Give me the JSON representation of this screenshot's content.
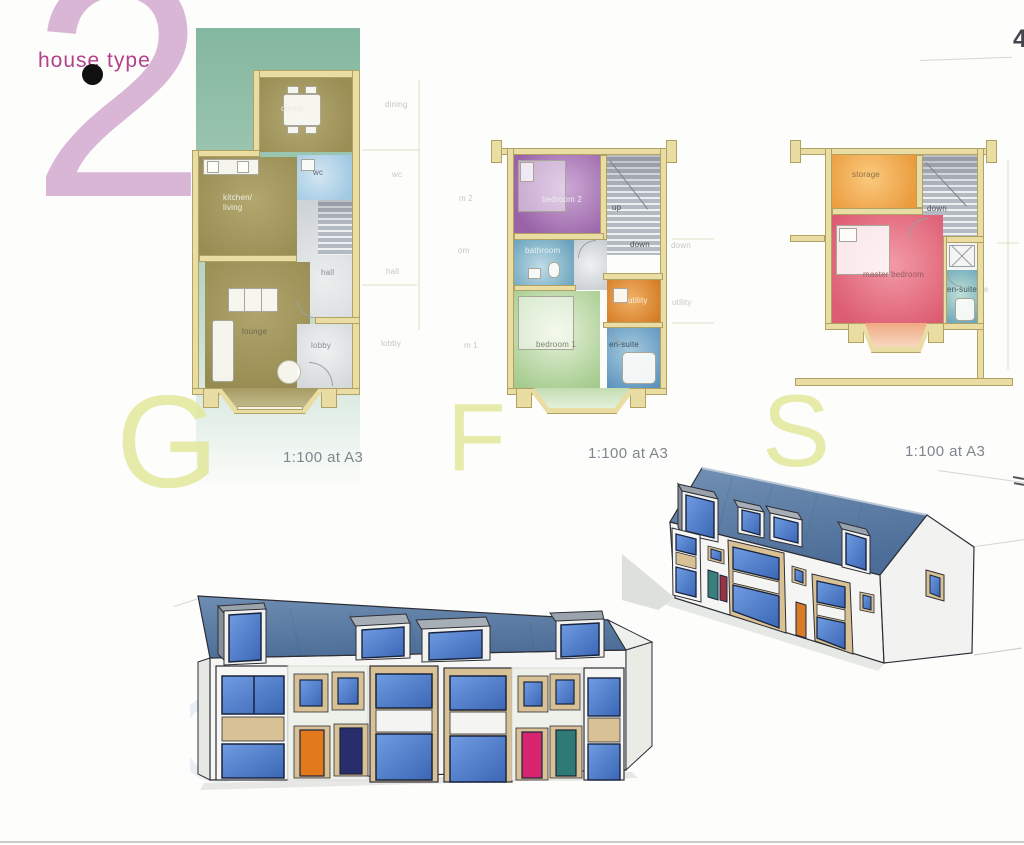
{
  "title": {
    "label": "house type",
    "number": "2",
    "corner_mark": "4"
  },
  "scale_note": "1:100 at A3",
  "floors": {
    "ground": {
      "letter": "G"
    },
    "first": {
      "letter": "F"
    },
    "second": {
      "letter": "S"
    }
  },
  "rooms": {
    "ground": {
      "dining": "dining",
      "wc": "wc",
      "kitchen_living": "kitchen/\nliving",
      "hall": "hall",
      "lounge": "lounge",
      "lobby": "lobby"
    },
    "first": {
      "bedroom2": "bedroom 2",
      "up": "up",
      "down": "down",
      "bathroom": "bathroom",
      "utility": "utility",
      "bedroom1": "bedroom 1",
      "ensuite": "en-suite"
    },
    "second": {
      "storage": "storage",
      "down": "down",
      "master": "master bedroom",
      "ensuite": "en-suite"
    }
  },
  "ghosts": {
    "ground": {
      "dining": "dining",
      "wc": "wc",
      "hall": "hall",
      "lobby": "lobby"
    },
    "first": {
      "m2": "m 2",
      "om": "om",
      "m1": "m 1",
      "down": "down",
      "utility": "utility"
    },
    "second": {
      "e": "e"
    }
  },
  "colors": {
    "type_number_pink": "#d9b6d6",
    "title_magenta": "#b5408a",
    "letter_yellow_green": "#e3e89b",
    "backdrop_green": "#86b8a1",
    "wall_tan": "#e9dda3",
    "olive_room": "#a39a5f",
    "wc_blue": "#aed0e6",
    "bedroom2_purple": "#9a63a8",
    "bathroom_teal": "#6ba4bd",
    "bedroom1_green": "#aacd94",
    "utility_orange": "#dd8128",
    "ensuite_blue": "#6097c0",
    "storage_orange": "#efa448",
    "master_red": "#e06276",
    "roof_slate": "#5b7ca6",
    "panel_buff": "#d8c194",
    "window_blue": "#4a7fd0",
    "door_orange": "#e2791c",
    "door_navy": "#272e6b",
    "door_pink": "#d6256e",
    "door_teal": "#2f7a74"
  }
}
